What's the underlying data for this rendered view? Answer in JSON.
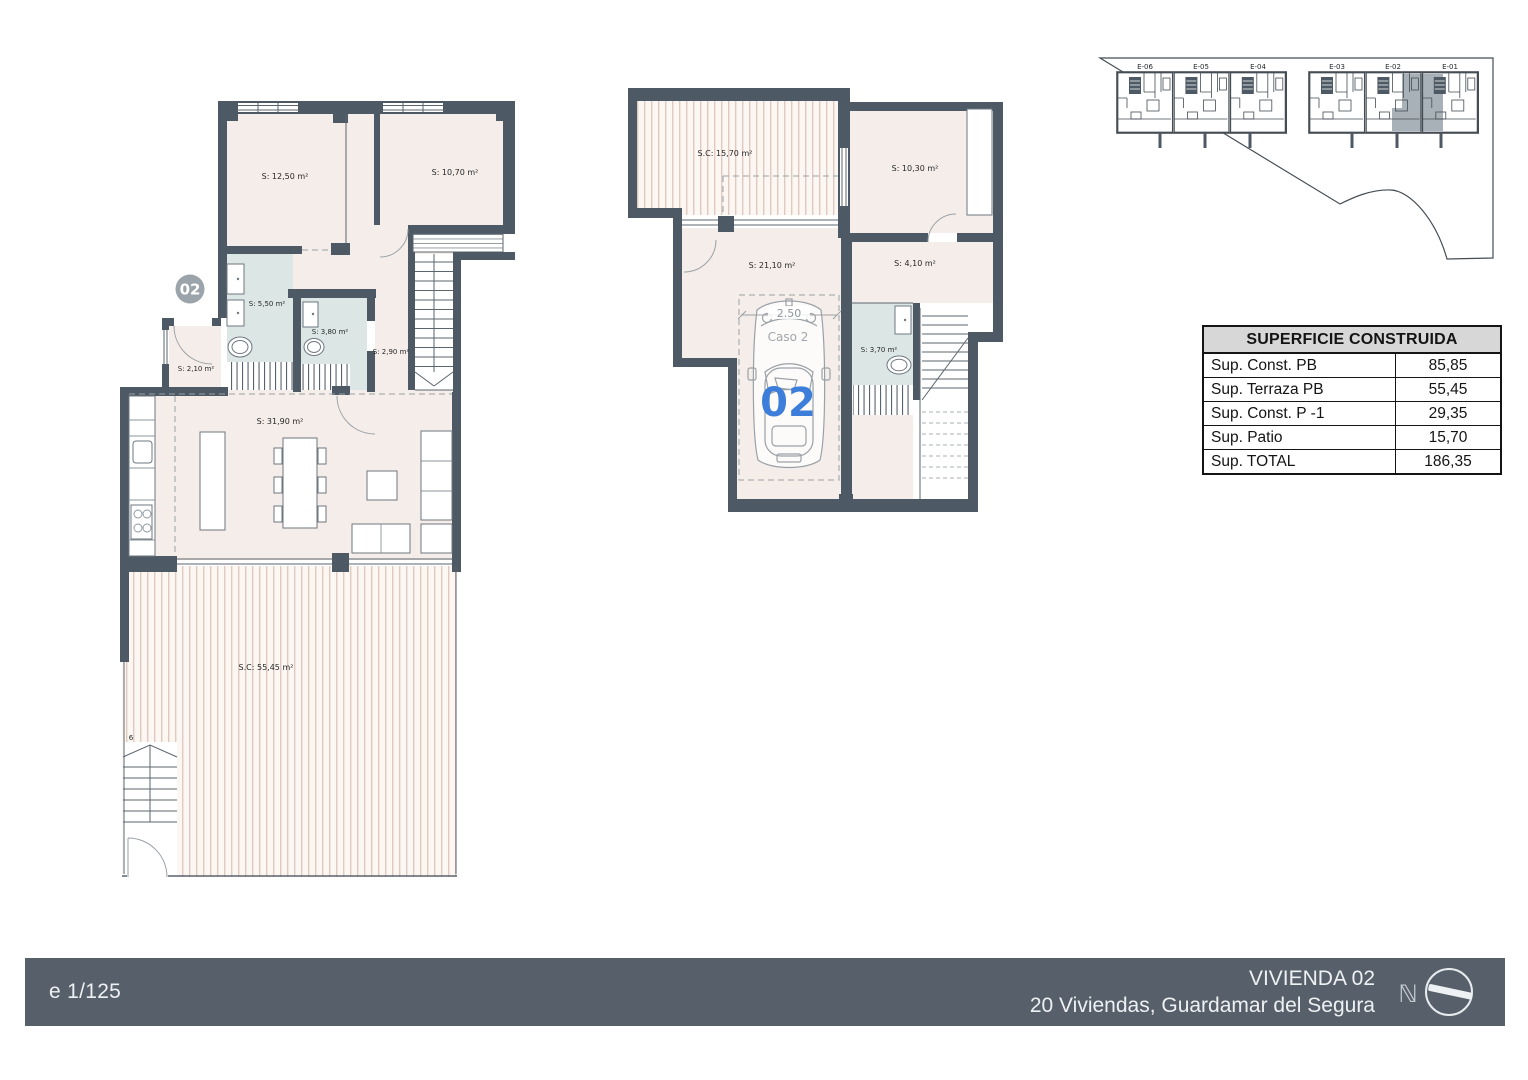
{
  "ground_floor": {
    "unit_badge": "02",
    "labels": {
      "bedroom1": "S: 12,50 m²",
      "bedroom2": "S: 10,70 m²",
      "bath1": "S: 5,50 m²",
      "bath2": "S: 3,80 m²",
      "hall": "S: 2,90 m²",
      "entry": "S: 2,10 m²",
      "living": "S: 31,90 m²",
      "terrace": "S.C: 55,45 m²",
      "stair_number": "6"
    }
  },
  "lower_floor": {
    "labels": {
      "patio": "S.C: 15,70 m²",
      "bedroom": "S: 10,30 m²",
      "garage": "S: 21,10 m²",
      "storage": "S: 4,10 m²",
      "bath": "S: 3,70 m²"
    },
    "car": {
      "number": "02",
      "case_label": "Caso 2",
      "width_dimension": "2.50"
    }
  },
  "site_plan": {
    "units": [
      "E-06",
      "E-05",
      "E-04",
      "E-03",
      "E-02",
      "E-01"
    ],
    "highlighted_unit": "E-02"
  },
  "area_table": {
    "title": "SUPERFICIE CONSTRUIDA",
    "rows": [
      {
        "label": "Sup. Const. PB",
        "value": "85,85"
      },
      {
        "label": "Sup. Terraza PB",
        "value": "55,45"
      },
      {
        "label": "Sup. Const. P -1",
        "value": "29,35"
      },
      {
        "label": "Sup. Patio",
        "value": "15,70"
      },
      {
        "label": "Sup. TOTAL",
        "value": "186,35"
      }
    ]
  },
  "title_block": {
    "scale": "e 1/125",
    "dwelling": "VIVIENDA 02",
    "project": "20 Viviendas, Guardamar del Segura",
    "north_letter": "ℕ"
  },
  "colors": {
    "wall": "#4d5964",
    "floor": "#f5ede9",
    "bath": "#dce6e5",
    "terrace_stripe": "#e0c9bf",
    "unit_highlight": "#a9b1b8",
    "accent_blue": "#3c7ed9",
    "bar_background": "#57606a"
  }
}
